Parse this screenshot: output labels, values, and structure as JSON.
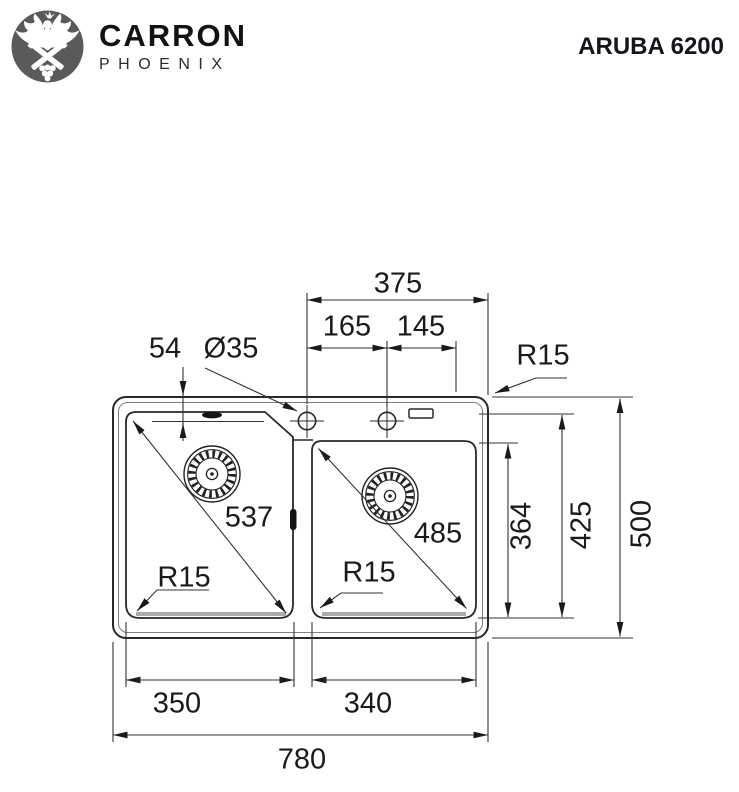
{
  "header": {
    "logo_icon": "carron-phoenix-crest-icon",
    "brand_line1": "CARRON",
    "brand_line2": "PHOENIX",
    "model": "ARUBA 6200"
  },
  "drawing": {
    "view": "sink-plan-view-technical-drawing",
    "dims": {
      "overall_width": "780",
      "overall_depth": "500",
      "tap_span": "375",
      "tap_spacing_left": "165",
      "tap_spacing_right": "145",
      "tap_offset_front": "54",
      "tap_hole_dia": "Ø35",
      "radius": "R15",
      "left_bowl_diag": "537",
      "right_bowl_diag": "485",
      "right_bowl_length": "364",
      "left_bowl_length": "425",
      "left_bowl_width": "350",
      "right_bowl_width": "340"
    }
  },
  "colors": {
    "line": "#282828",
    "dim_line": "#333333",
    "text": "#1a1a1a",
    "logo_bg": "#595a5c",
    "shadow": "#ababab",
    "background": "#ffffff"
  }
}
